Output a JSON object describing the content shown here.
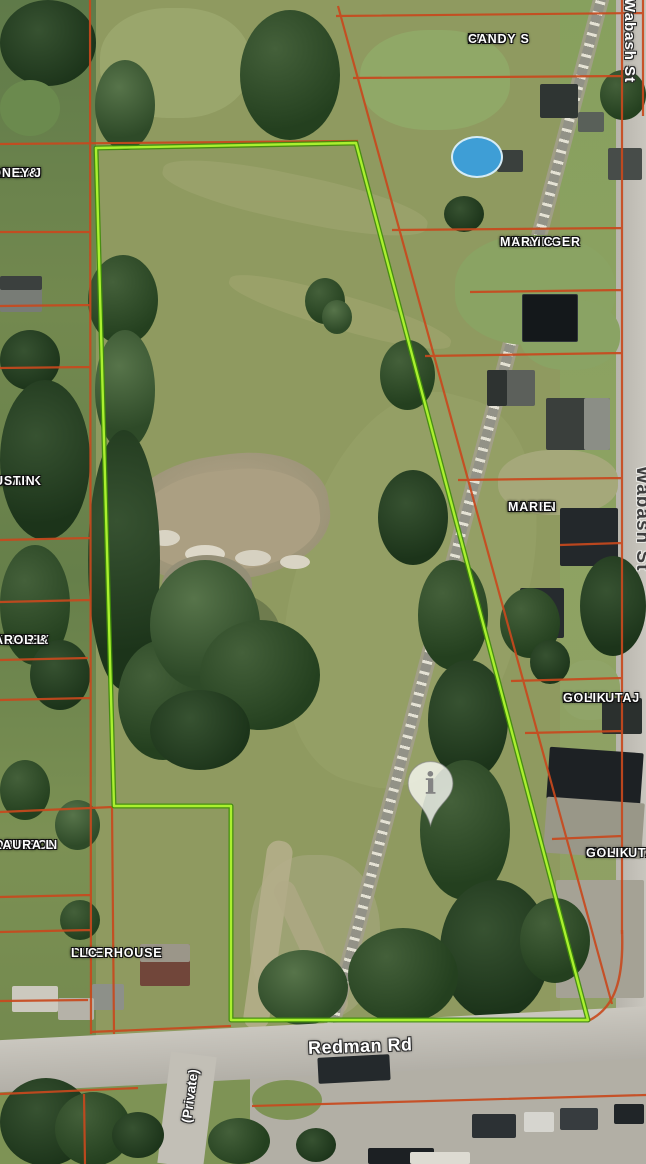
{
  "map_labels": {
    "parcels": [
      {
        "name": "frye-candy",
        "lines": [
          "FRYE",
          "CANDY S",
          ""
        ]
      },
      {
        "name": "anson",
        "lines": [
          "ANSON",
          "DA E &",
          "DNEY J"
        ]
      },
      {
        "name": "mellinger",
        "lines": [
          "MELLINGER",
          "MARY C",
          ""
        ]
      },
      {
        "name": "clark",
        "lines": [
          "CLARK",
          "USTIN",
          ""
        ]
      },
      {
        "name": "baker",
        "lines": [
          "BAKER",
          "KAREN",
          "MARIE"
        ]
      },
      {
        "name": "ashley",
        "lines": [
          "ASHLEY",
          "YLE R &",
          "AROL L"
        ]
      },
      {
        "name": "mahmutaj-golik",
        "lines": [
          "MAHMUTAJ",
          "GOLIK",
          ""
        ]
      },
      {
        "name": "robinson",
        "lines": [
          "OBINSON",
          "LAURA L",
          ""
        ]
      },
      {
        "name": "mahmutah-golik",
        "lines": [
          "MAHMUTAH",
          "GOLIK",
          ""
        ]
      },
      {
        "name": "ciderhouse",
        "lines": [
          "CIDERHOUSE",
          "LLC",
          ""
        ]
      }
    ],
    "roads": {
      "wabash_top": "Wabash St",
      "wabash_mid": "Wabash St",
      "redman": "Redman Rd",
      "private": "(Private)"
    },
    "marker_glyph": "i"
  },
  "colors": {
    "parcel_boundary": "#c8491d",
    "subject_parcel_outline": "#aaf02f",
    "subject_parcel_outline_dark": "#3f8c0a",
    "label_text": "#ffffff",
    "road_surface": "#c6c3bb"
  }
}
